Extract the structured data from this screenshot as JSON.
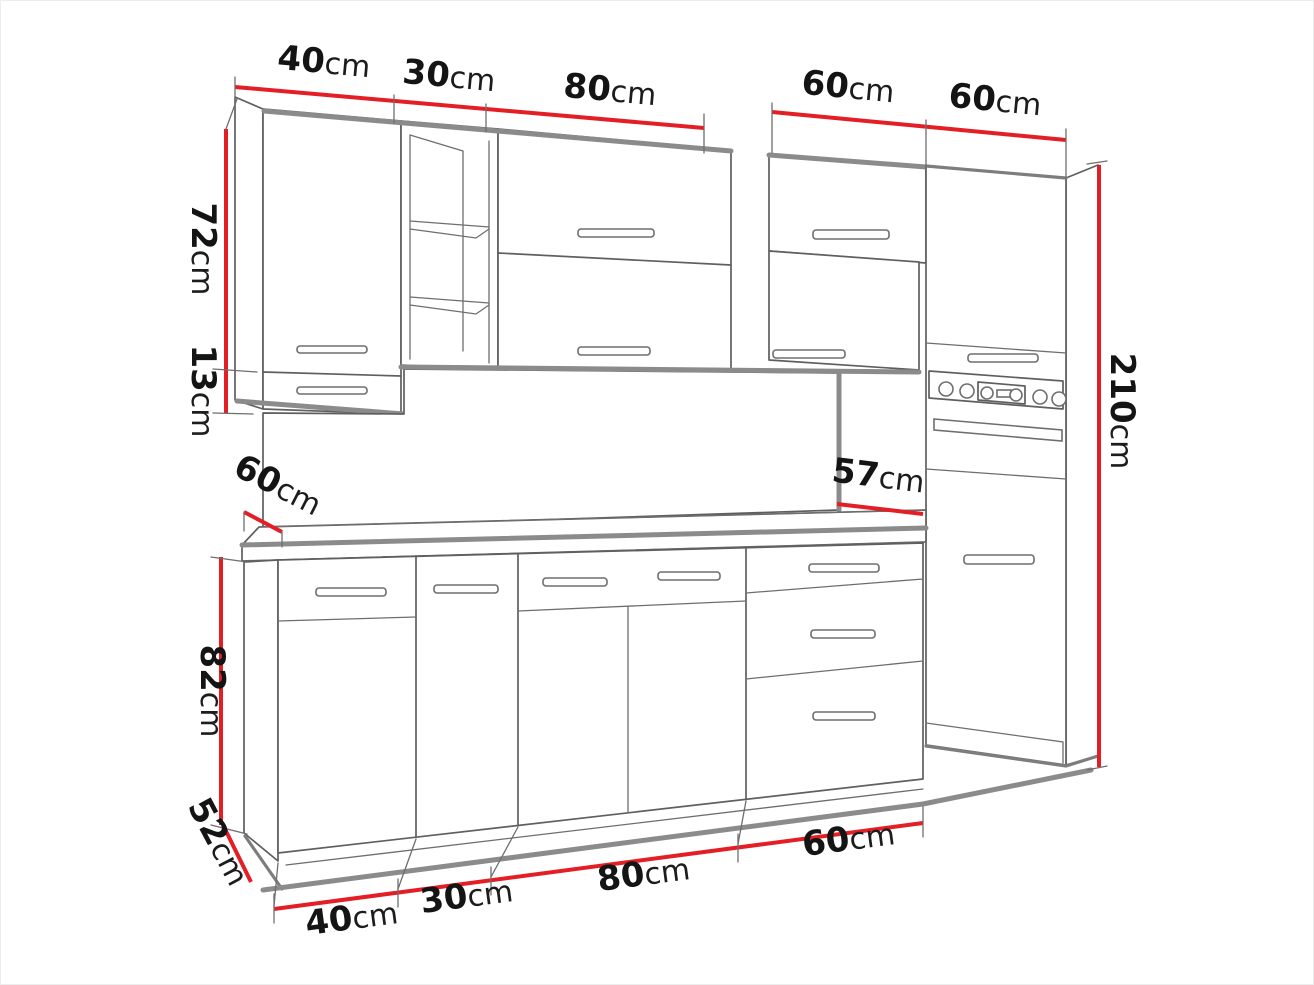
{
  "diagram": {
    "title": "kitchen cabinet set dimension drawing",
    "unit": "cm",
    "colors": {
      "dimension_line": "#e31e24",
      "sketch_line": "#5f5f5f",
      "shadow_line": "#8b8b8b",
      "text": "#141414",
      "background": "#ffffff"
    },
    "dims": {
      "top_40": {
        "num": "40",
        "unit": "cm"
      },
      "top_30": {
        "num": "30",
        "unit": "cm"
      },
      "top_80": {
        "num": "80",
        "unit": "cm"
      },
      "top_60a": {
        "num": "60",
        "unit": "cm"
      },
      "top_60b": {
        "num": "60",
        "unit": "cm"
      },
      "left_72": {
        "num": "72",
        "unit": "cm"
      },
      "left_13": {
        "num": "13",
        "unit": "cm"
      },
      "worktop_depth_60": {
        "num": "60",
        "unit": "cm"
      },
      "splash_57": {
        "num": "57",
        "unit": "cm"
      },
      "right_210": {
        "num": "210",
        "unit": "cm"
      },
      "left_82": {
        "num": "82",
        "unit": "cm"
      },
      "left_52": {
        "num": "52",
        "unit": "cm"
      },
      "bottom_40": {
        "num": "40",
        "unit": "cm"
      },
      "bottom_30": {
        "num": "30",
        "unit": "cm"
      },
      "bottom_80": {
        "num": "80",
        "unit": "cm"
      },
      "bottom_60": {
        "num": "60",
        "unit": "cm"
      }
    }
  }
}
